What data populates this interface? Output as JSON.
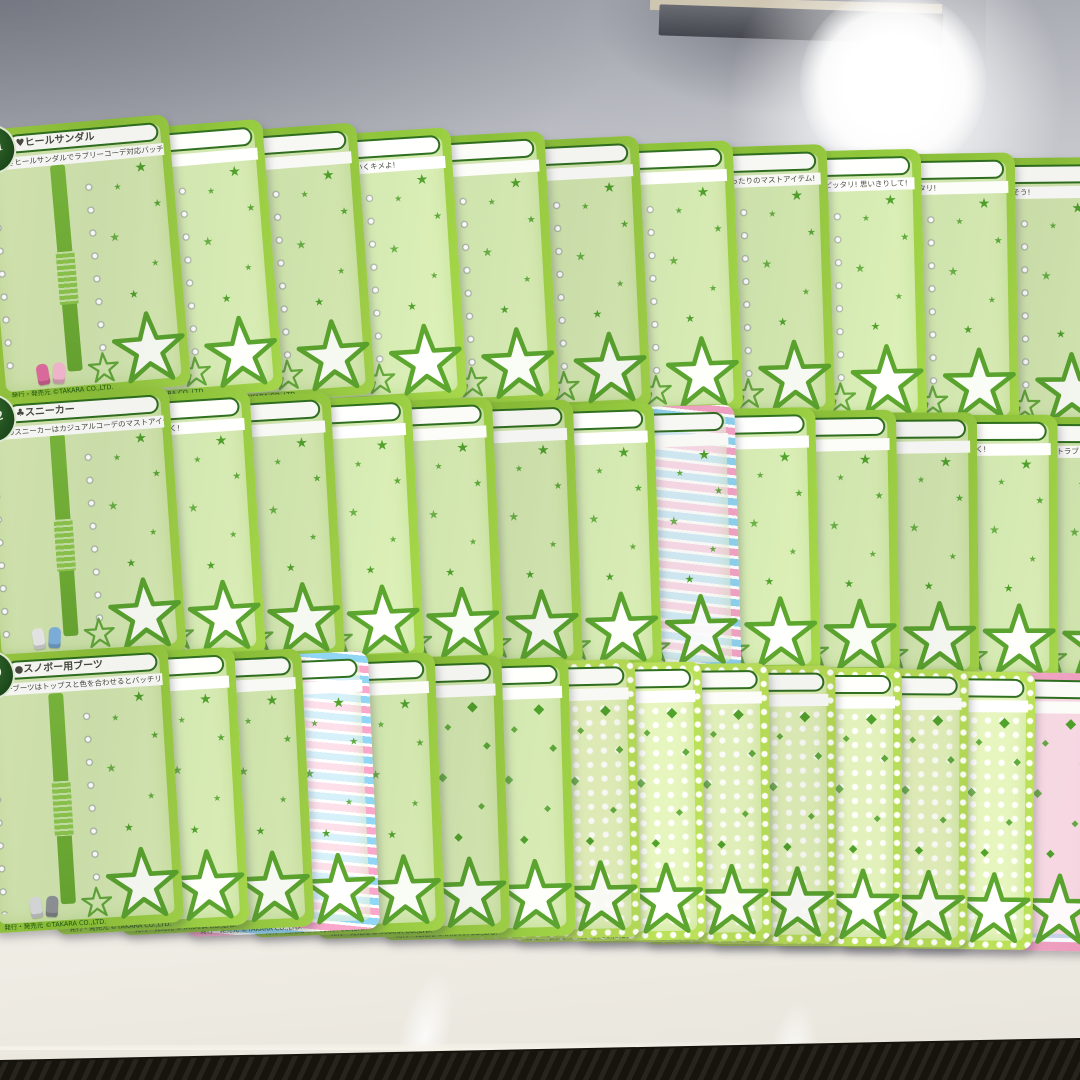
{
  "scene": {
    "surface": "white table top",
    "background_top": "gray wall shadow area",
    "top_object": "dark object at top center with tan edge",
    "light_glare": "bright camera light reflection, upper right",
    "floor": "dark floor visible along bottom edge"
  },
  "palette": {
    "card_frame_green": "#93c73e",
    "inner_bar_green": "#6dad36",
    "star_green": "#4f9e2b",
    "title_border_green": "#2f6e1f",
    "badge_green": "#235722",
    "polka_green": "#b5da55",
    "stripe_pink": "#f2a2c4",
    "stripe_blue": "#8ed0ee",
    "pink_frame": "#f0a6c4",
    "table_white": "#ece9e1",
    "floor_dark": "#16120c"
  },
  "cards": {
    "footer_text": "発行・発売元 ©TAKARA CO.,LTD.",
    "rows": [
      {
        "items": [
          {
            "badge": "S-01",
            "title": "♥ヒールサンダル",
            "desc": "お花つきヒールサンダルでラブリーコーデ対応バッチリ!",
            "motif": "star",
            "shoes": [
              "#e06c9f",
              "#f5b8d0"
            ]
          },
          {
            "title": "…ー",
            "desc": "…デもバッチリ!",
            "motif": "star",
            "shoes": [
              "#f3f3f3",
              "#d8d8d8"
            ]
          },
          {
            "title": "…カー",
            "desc": "…カーで元気いっぱい!",
            "motif": "star",
            "shoes": [
              "#ef9ab5",
              "#f7c6d8"
            ]
          },
          {
            "title": "…ュール",
            "desc": "ピンクのスニーカーでかわいくキメよ!",
            "motif": "star",
            "shoes": [
              "#f5f5f5",
              "#e3e3e3"
            ]
          },
          {
            "title": "…プス",
            "desc": "…で足元は軽やかに",
            "motif": "star",
            "shoes": [
              "#bfc3c9",
              "#9aa0a8"
            ]
          },
          {
            "title": "",
            "desc": "…プスでステキ度UP!",
            "motif": "star",
            "shoes": [
              "#2a2a2e",
              "#3a3a40"
            ]
          },
          {
            "title": "",
            "desc": "…ワンランクUP!",
            "motif": "star",
            "shoes": [
              "#e8a9c6",
              "#f2c3da"
            ]
          },
          {
            "title": "…シューズ",
            "desc": "…ランクブーツは梅雨にぴったりのマストアイテム!",
            "motif": "star",
            "shoes": [
              "#d46a78",
              "#e89aa4"
            ]
          },
          {
            "title": "",
            "desc": "…はラブリーなスカートとピッタリ! 思いきりして!",
            "motif": "star",
            "shoes": [
              "#b9babc",
              "#d5d6d8"
            ]
          },
          {
            "title": "",
            "desc": "…はカラフル帽子かにピッタリ!",
            "motif": "star",
            "shoes": [
              "#efefef",
              "#dcdcdc"
            ]
          },
          {
            "title": "…ル",
            "desc": "クールなパンツにはきこなそう!",
            "motif": "star",
            "shoes": [
              "#f7f7f7",
              "#e8e8e8"
            ]
          }
        ]
      },
      {
        "items": [
          {
            "badge": "S-22",
            "title": "♣スニーカー",
            "desc": "ブルーのスニーカーはカジュアルコーデのマストアイテム!",
            "motif": "star",
            "shoes": [
              "#e9e9e9",
              "#7fb1de"
            ]
          },
          {
            "title": "",
            "desc": "…にかわいさをたして大人っぽく!",
            "motif": "star",
            "shoes": [
              "#f2f2f2",
              "#dadada"
            ]
          },
          {
            "title": "",
            "desc": "…はきこなして!",
            "motif": "star",
            "shoes": [
              "#ffffff",
              "#e5e5e5"
            ]
          },
          {
            "title": "",
            "desc": "…とマッチ ピッタリ!",
            "motif": "star",
            "shoes": [
              "#e9e9e9",
              "#cfcfcf"
            ]
          },
          {
            "title": "",
            "desc": "…にすべっちゃうよ!",
            "motif": "star",
            "shoes": [
              "#f0c6d8",
              "#e5a8c4"
            ]
          },
          {
            "title": "",
            "desc": "…スイートセレクト!",
            "motif": "star",
            "shoes": [
              "#caa06a",
              "#8a5a32"
            ]
          },
          {
            "title": "…スタンブーツ",
            "desc": "…はブーツに合わないよ!",
            "motif": "star",
            "shoes": [
              "#8a5a36",
              "#6e4426"
            ]
          },
          {
            "title": "…サンタブーツ",
            "desc": "…はコンサートにぴったり!",
            "style": "stripe",
            "motif": "star",
            "shoes": [
              "#cf3b3b",
              "#ffffff"
            ]
          },
          {
            "title": "…サンダル",
            "desc": "…ムにぴったり!",
            "motif": "star",
            "shoes": [
              "#6aaede",
              "#9ccbec"
            ]
          },
          {
            "title": "",
            "desc": "…コーディネートにぴったり!",
            "motif": "star",
            "shoes": [
              "#7b4a2d",
              "#95613e"
            ]
          },
          {
            "title": "…ブーツ",
            "desc": "…スタイルとぴったり!",
            "motif": "star",
            "shoes": [
              "#5d9fd4",
              "#85bce4"
            ]
          },
          {
            "title": "",
            "desc": "…ゴムとコーデインでかっこよく!",
            "motif": "star",
            "shoes": [
              "#c9a36a",
              "#dcbd8c"
            ]
          },
          {
            "title": "…サンダル",
            "desc": "ヒールの高いサンダルでスイートラブリー気分♪",
            "motif": "star",
            "shoes": [
              "#f3ead8",
              "#c03a4a"
            ]
          }
        ]
      },
      {
        "items": [
          {
            "badge": "S-59",
            "title": "●スノボー用ブーツ",
            "desc": "スノボーブーツはトップスと色を合わせるとバッチリ!",
            "motif": "star",
            "shoes": [
              "#d8dadc",
              "#8e9296"
            ]
          },
          {
            "title": "",
            "desc": "…ンプスにぴったり!",
            "motif": "star",
            "shoes": [
              "#9db8d8",
              "#b8cde4"
            ]
          },
          {
            "title": "…ンプス",
            "desc": "…トップスと色を合わせて!",
            "motif": "star",
            "shoes": [
              "#7fb3dd",
              "#a4cbe8"
            ]
          },
          {
            "title": "",
            "desc": "…スと合わせてスリムに!",
            "style": "stripe",
            "motif": "star",
            "shoes": [
              "#e583a8",
              "#f0a8c4"
            ]
          },
          {
            "title": "…ブーツ",
            "desc": "…には外でなして!",
            "motif": "star",
            "shoes": [
              "#b9a2d8",
              "#cfc0e6"
            ]
          },
          {
            "title": "…ーツ",
            "desc": "…にパンツをイン!",
            "vbar": "stripe",
            "motif": "diamond",
            "shoes": [
              "#e5e5e5",
              "#f2f2f2"
            ]
          },
          {
            "title": "…ル",
            "desc": "…カジュアルに大人気♡",
            "motif": "diamond",
            "shoes": [
              "#caa888",
              "#b9946e"
            ]
          },
          {
            "title": "…ル",
            "desc": "…スカートにぴったり!",
            "style": "dots",
            "motif": "diamond",
            "shoes": [
              "#8a8f94",
              "#a5abb1"
            ]
          },
          {
            "title": "",
            "desc": "…と合わせてファンタスティック!",
            "style": "dots",
            "motif": "diamond",
            "shoes": [
              "#e2b77f",
              "#eecb9c"
            ]
          },
          {
            "title": "",
            "desc": "…はマストアイテム!",
            "style": "dots",
            "motif": "diamond",
            "shoes": [
              "#d87fa8",
              "#e8a4c2"
            ]
          },
          {
            "title": "",
            "desc": "…と合わせてコーデして!",
            "style": "dots",
            "motif": "diamond",
            "shoes": [
              "#c9c9c9",
              "#dcdcdc"
            ]
          },
          {
            "title": "",
            "desc": "…てフェミニンに!",
            "style": "dots",
            "motif": "diamond",
            "shoes": [
              "#a8c8e8",
              "#c2d8f0"
            ]
          },
          {
            "title": "",
            "desc": "…でアクティブに!",
            "style": "dots",
            "motif": "diamond",
            "shoes": [
              "#e8c8a8",
              "#f0dcc2"
            ]
          },
          {
            "title": "",
            "desc": "…でカジュアルに!",
            "style": "dots",
            "motif": "diamond",
            "shoes": [
              "#ffffff",
              "#e2e2e2"
            ]
          },
          {
            "title": "",
            "desc": "…でピュアに♪",
            "style": "pink",
            "motif": "diamond",
            "shoes": [
              "#88c8e8",
              "#f0a8c8"
            ]
          }
        ]
      }
    ]
  }
}
